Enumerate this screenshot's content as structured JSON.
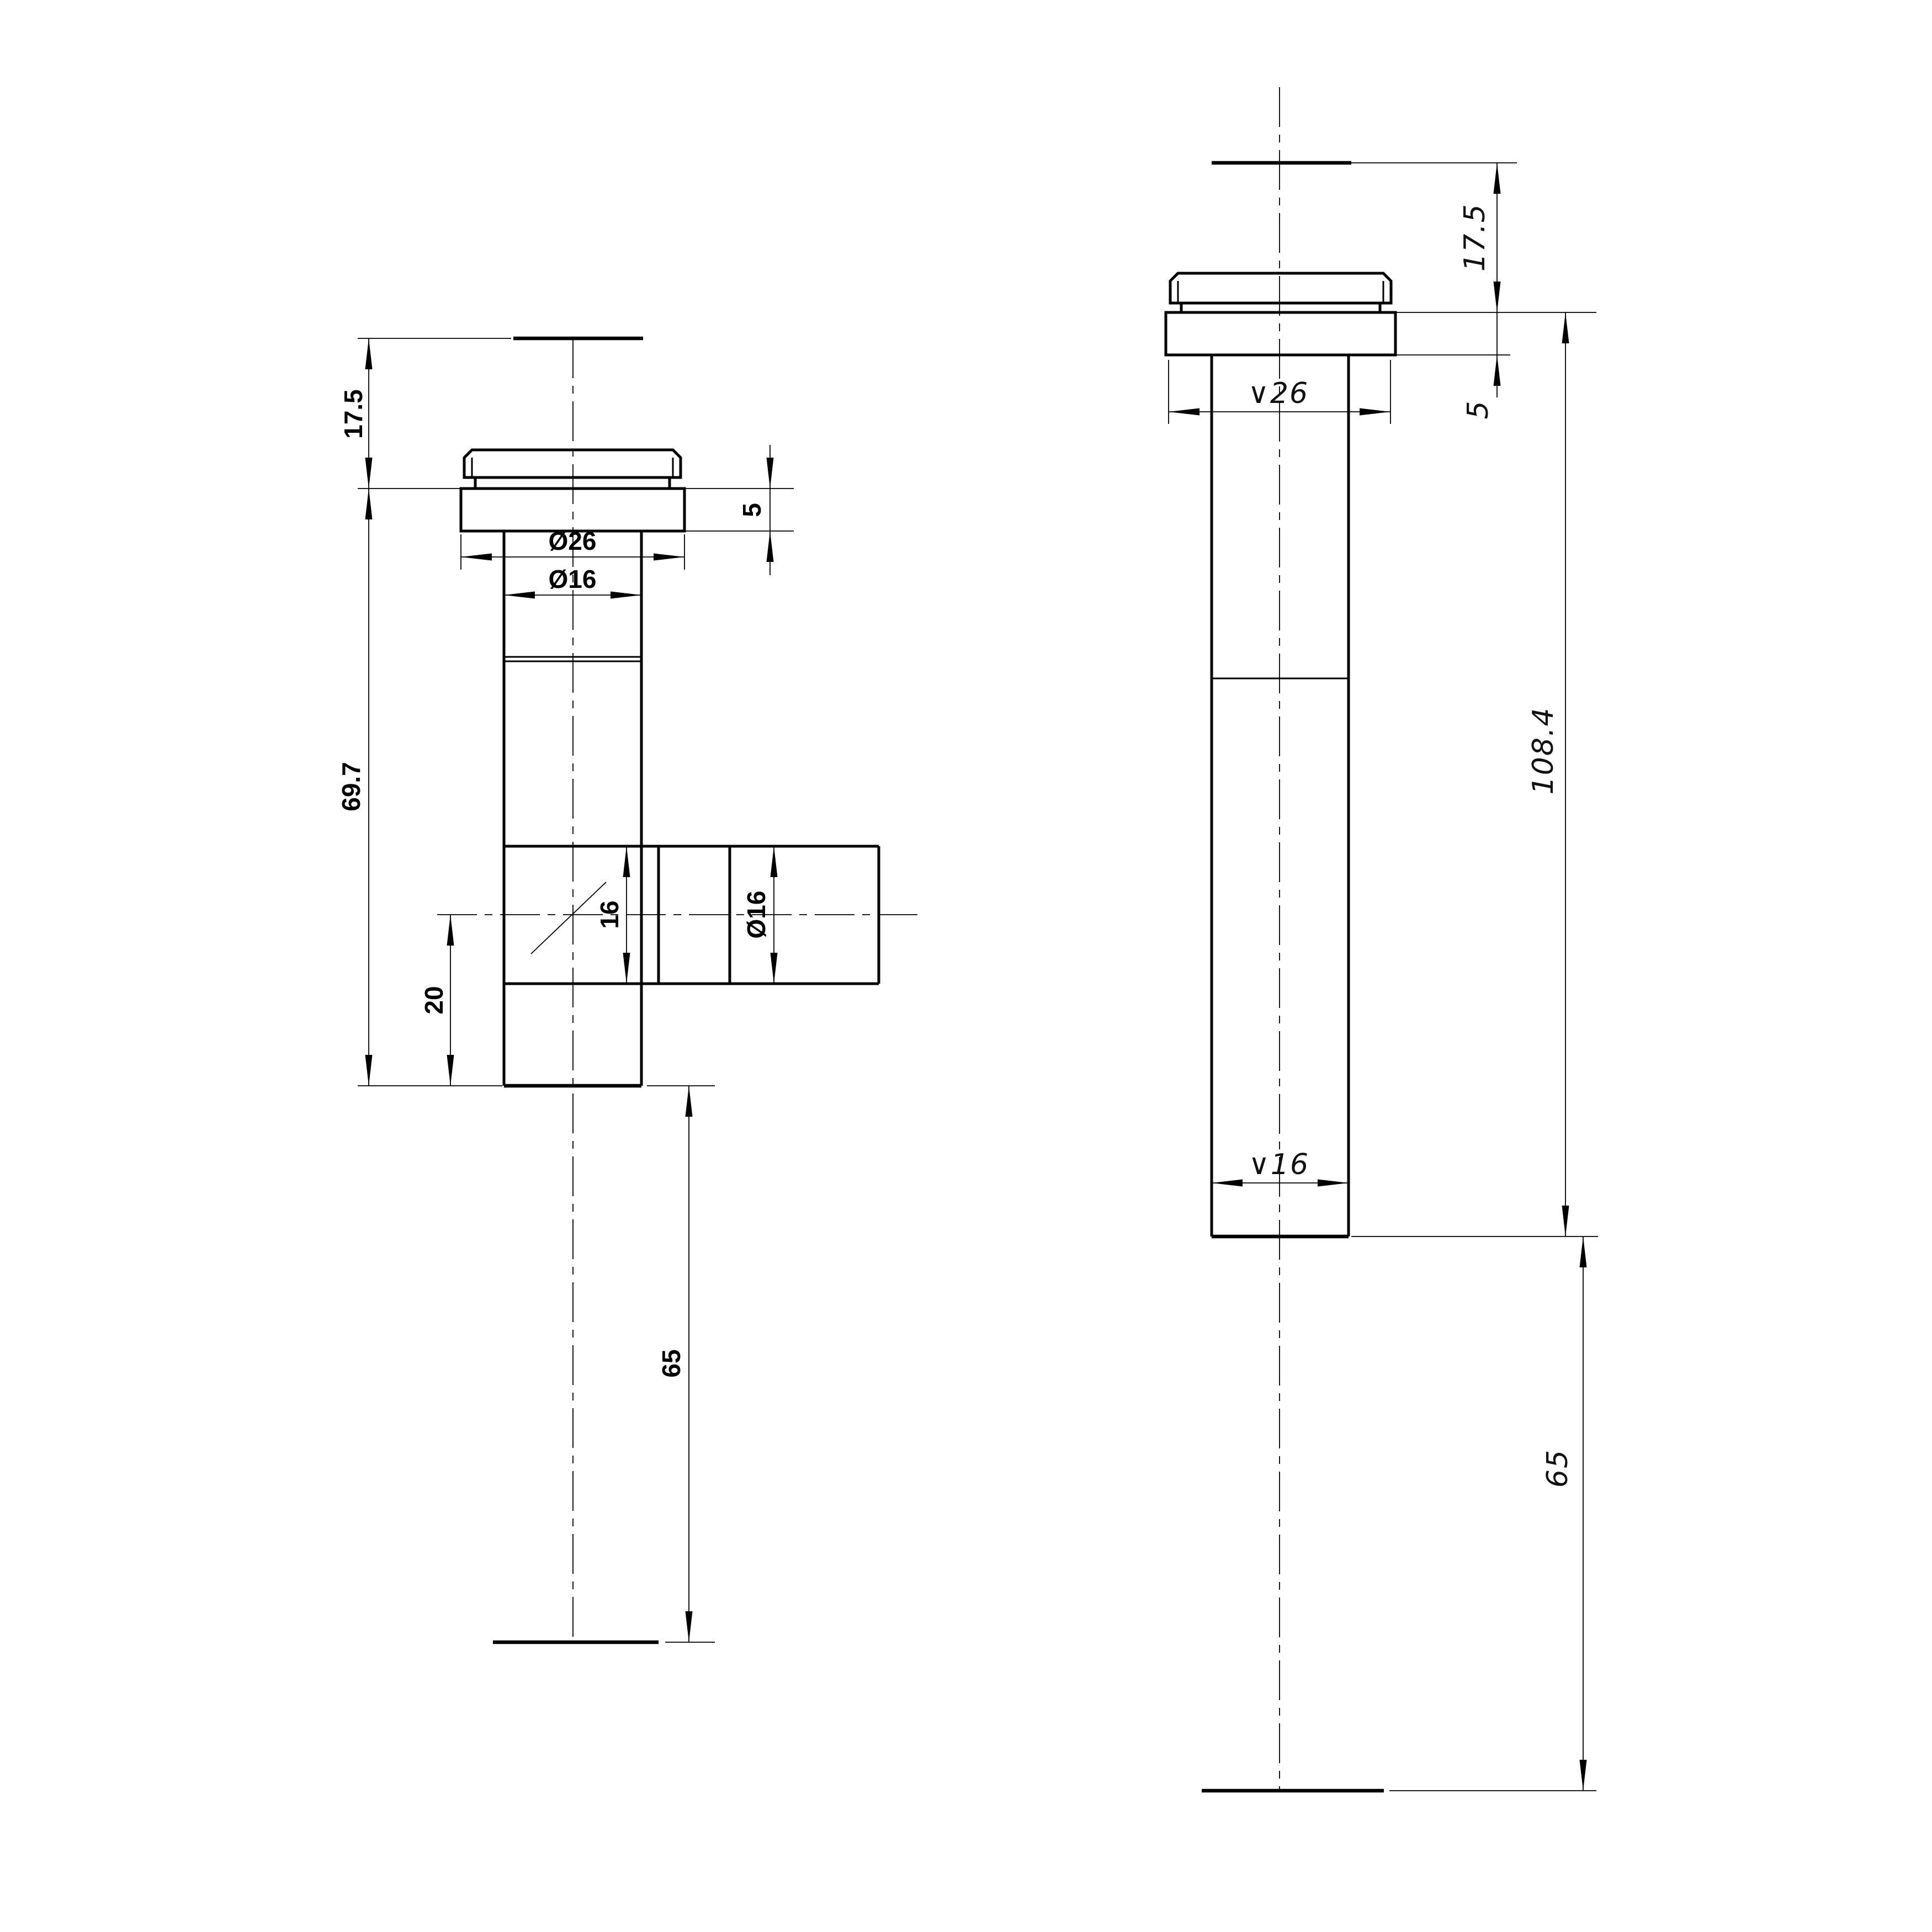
{
  "page": {
    "background": "#ffffff",
    "line_color": "#000000"
  },
  "front_view": {
    "dim_stub_height": "17.5",
    "dim_flange_diameter": "Ø26",
    "dim_pipe_diameter": "Ø16",
    "dim_flange_thickness": "5",
    "dim_body_length": "69.7",
    "dim_branch_bore": "16",
    "dim_branch_diameter": "Ø16",
    "dim_branch_offset": "20",
    "dim_tail_length": "65"
  },
  "side_view": {
    "dim_stub_height": "17.5",
    "dim_flange_diameter": "∨26",
    "dim_flange_thickness": "5",
    "dim_overall_length": "108.4",
    "dim_pipe_diameter": "∨16",
    "dim_tail_length": "65"
  }
}
